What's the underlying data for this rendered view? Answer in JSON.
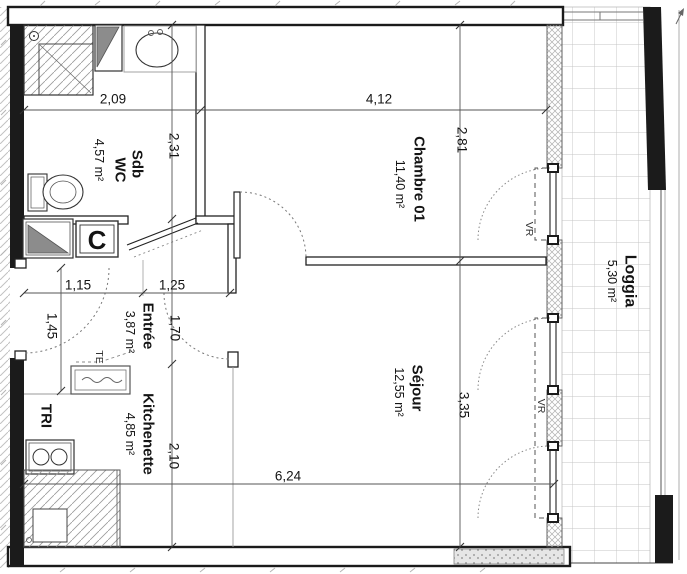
{
  "plan": {
    "type": "floor-plan",
    "rooms": {
      "sdb": {
        "line1": "Sdb",
        "line2": "WC",
        "area": "4,57 m²"
      },
      "chambre": {
        "name": "Chambre 01",
        "area": "11,40 m²"
      },
      "entree": {
        "name": "Entrée",
        "area": "3,87 m²"
      },
      "sejour": {
        "name": "Séjour",
        "area": "12,55 m²"
      },
      "kitchenette": {
        "name": "Kitchenette",
        "area": "4,85 m²"
      },
      "loggia": {
        "name": "Loggia",
        "area": "5,30 m²"
      },
      "tri": {
        "name": "TRI"
      }
    },
    "fixtures": {
      "closet_label": "C",
      "electrical_panel_label": "TE"
    },
    "windows": {
      "chambre_shutter": "VR",
      "sejour_shutter": "VR"
    },
    "dimensions_m": {
      "sdb_width": "2,09",
      "chambre_width": "4,12",
      "sdb_height": "2,31",
      "chambre_height": "2,81",
      "entree_width_left": "1,15",
      "entree_width_right": "1,25",
      "entree_door": "1,45",
      "entree_height": "1,70",
      "sejour_height": "3,35",
      "kitchenette_height": "2,10",
      "living_width": "6,24"
    },
    "colors": {
      "paper": "#ffffff",
      "wall_black": "#1b1b1b",
      "line": "#2a2a2a",
      "dim_line": "#555555",
      "hatch": "#9a9a9a",
      "fixture_gray": "#8c8c8c",
      "tile_grid": "#c4c4c4"
    }
  }
}
